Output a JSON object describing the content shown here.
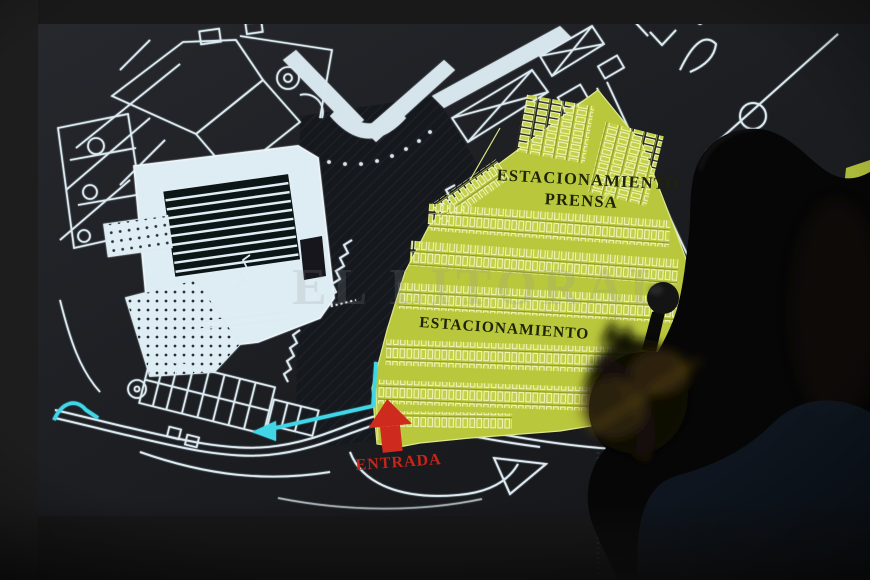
{
  "plan": {
    "press_parking_line1": "ESTACIONAMIENTO",
    "press_parking_line2": "PRENSA",
    "main_parking": "ESTACIONAMIENTO",
    "entrance": "ENTRADA"
  },
  "watermark": {
    "text": "EL LITORAL"
  },
  "colors": {
    "parking_highlight": "#b9c73c",
    "plan_lines": "#dcebf2",
    "entrance_red": "#cf2a1e",
    "route_cyan": "#3fd6e8",
    "label_ink": "#1f2408"
  }
}
